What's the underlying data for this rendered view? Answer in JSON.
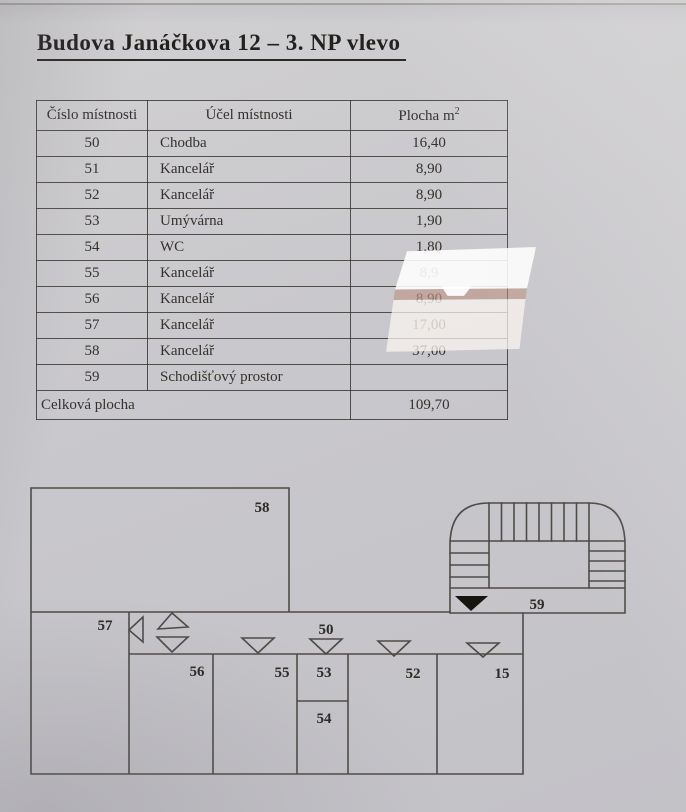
{
  "page": {
    "title": "Budova Janáčkova 12 – 3. NP vlevo"
  },
  "table": {
    "headers": {
      "cislo": "Číslo místnosti",
      "ucel": "Účel místnosti",
      "plocha": "Plocha m",
      "plocha_sup": "2"
    },
    "rows": [
      {
        "cislo": "50",
        "ucel": "Chodba",
        "plocha": "16,40"
      },
      {
        "cislo": "51",
        "ucel": "Kancelář",
        "plocha": "8,90"
      },
      {
        "cislo": "52",
        "ucel": "Kancelář",
        "plocha": "8,90"
      },
      {
        "cislo": "53",
        "ucel": "Umývárna",
        "plocha": "1,90"
      },
      {
        "cislo": "54",
        "ucel": "WC",
        "plocha": "1,80"
      },
      {
        "cislo": "55",
        "ucel": "Kancelář",
        "plocha": "8,9"
      },
      {
        "cislo": "56",
        "ucel": "Kancelář",
        "plocha": "8,90"
      },
      {
        "cislo": "57",
        "ucel": "Kancelář",
        "plocha": "17,00"
      },
      {
        "cislo": "58",
        "ucel": "Kancelář",
        "plocha": "37,00"
      },
      {
        "cislo": "59",
        "ucel": "Schodišťový prostor",
        "plocha": ""
      }
    ],
    "footer": {
      "label": "Celková plocha",
      "value": "109,70"
    }
  },
  "floorplan": {
    "labels": {
      "r58": "58",
      "r57": "57",
      "r50": "50",
      "r56": "56",
      "r55": "55",
      "r53": "53",
      "r54": "54",
      "r52": "52",
      "r15": "15",
      "r59": "59"
    }
  },
  "colors": {
    "paper": "#c9c8cc",
    "ink": "#35322d",
    "plan_line": "#44413c",
    "glare_white": "#fdfdfb",
    "glare_frame": "#ba8d7a"
  }
}
